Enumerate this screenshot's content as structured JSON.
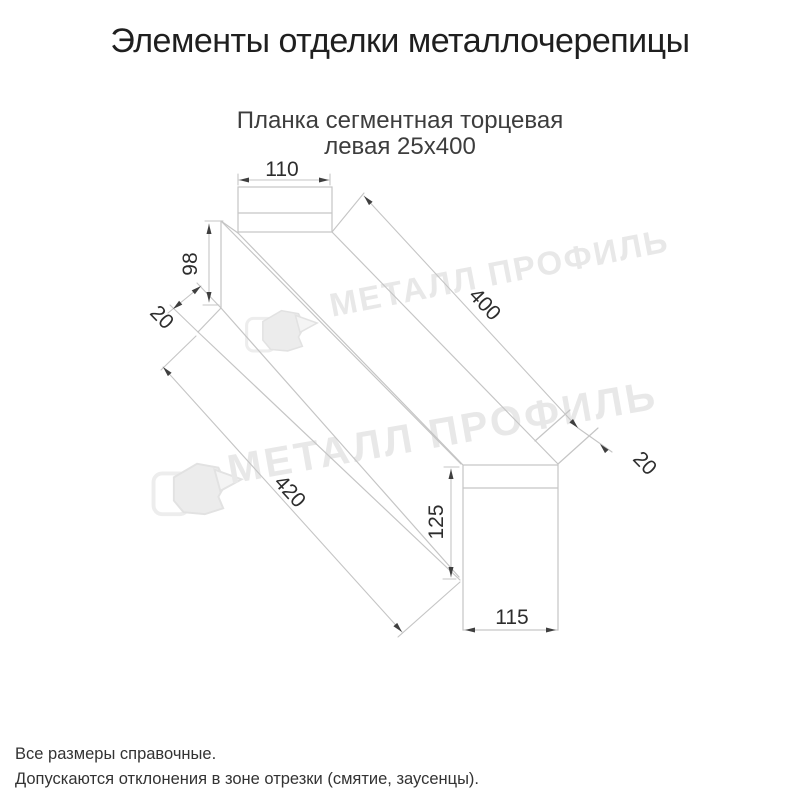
{
  "header": {
    "title": "Элементы отделки металлочерепицы"
  },
  "drawing": {
    "subtitle_line1": "Планка сегментная торцевая",
    "subtitle_line2": "левая 25х400",
    "dimensions": {
      "top_tab_width": "110",
      "left_end_height": "98",
      "left_hem": "20",
      "top_edge_length": "400",
      "right_hem": "20",
      "bottom_edge_length": "420",
      "right_end_height": "125",
      "right_end_width": "115"
    },
    "watermark": {
      "text": "МЕТАЛЛ ПРОФИЛЬ"
    },
    "colors": {
      "line": "#c5c5c5",
      "dim_text": "#2d2d2d",
      "arrow": "#3f3f3f",
      "watermark": "#e8e8e8"
    }
  },
  "footer": {
    "note1": "Все размеры справочные.",
    "note2": "Допускаются отклонения в зоне отрезки (смятие, заусенцы)."
  }
}
